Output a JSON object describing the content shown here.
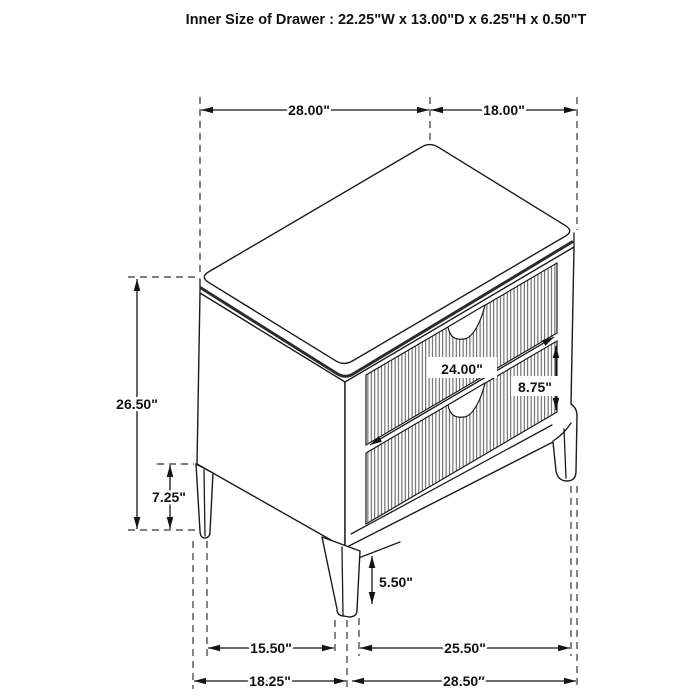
{
  "title": "Inner Size of Drawer : 22.25\"W x 13.00\"D x 6.25\"H x 0.50\"T",
  "dimensions": {
    "top_width": "28.00\"",
    "top_depth": "18.00\"",
    "overall_height": "26.50\"",
    "back_leg_height": "7.25\"",
    "drawer_front_width": "24.00\"",
    "drawer_front_height": "8.75\"",
    "front_leg_height": "5.50\"",
    "leg_span_side": "15.50\"",
    "leg_span_front": "25.50\"",
    "base_depth": "18.25\"",
    "base_width": "28.50″"
  },
  "colors": {
    "line": "#1b1b1b",
    "dimension": "#141414",
    "background": "#ffffff"
  }
}
